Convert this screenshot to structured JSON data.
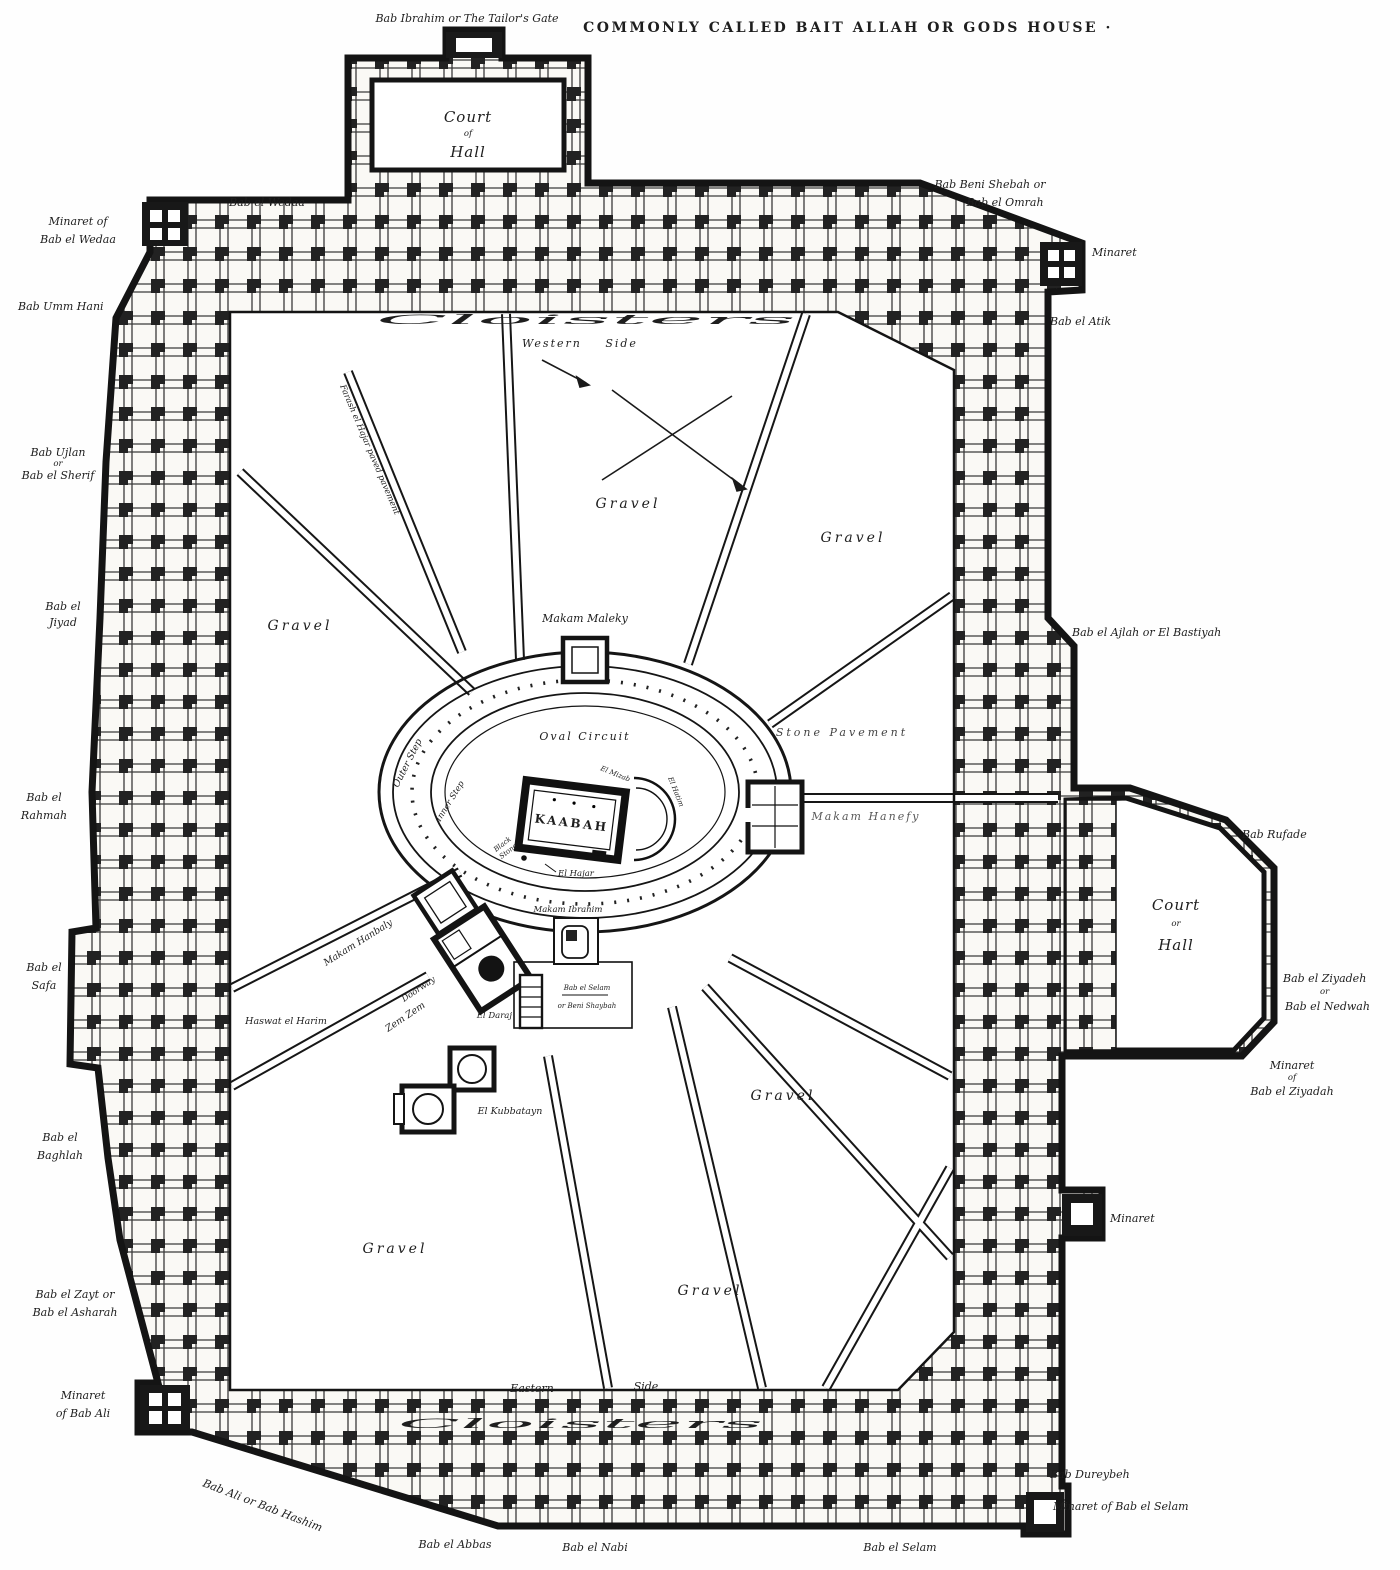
{
  "palette": {
    "ink": "#1c1c1c",
    "paper": "#ffffff"
  },
  "labels": {
    "title": "COMMONLY CALLED BAIT ALLAH OR GODS HOUSE ·",
    "bab_ibrahim": "Bab Ibrahim or The Tailor's Gate",
    "bab_el_wedaa": "Bab el Wedaa",
    "minaret_wedaa": [
      "Minaret of",
      "Bab el Wedaa"
    ],
    "bab_umm_hani": "Bab Umm Hani",
    "bab_ujlan": [
      "Bab Ujlan",
      "or",
      "Bab el Sherif"
    ],
    "bab_el_jiyad": [
      "Bab el",
      "Jiyad"
    ],
    "bab_el_rahmah": [
      "Bab el",
      "Rahmah"
    ],
    "bab_el_safa": [
      "Bab el",
      "Safa"
    ],
    "bab_el_baghlah": [
      "Bab el",
      "Baghlah"
    ],
    "bab_el_zayt": [
      "Bab el Zayt or",
      "Bab el Asharah"
    ],
    "minaret_bab_ali": [
      "Minaret",
      "of Bab Ali"
    ],
    "bab_ali_hashim": "Bab Ali or Bab Hashim",
    "bab_el_abbas": "Bab el Abbas",
    "bab_el_nabi": "Bab el Nabi",
    "bab_el_selam": "Bab el Selam",
    "bab_dureybeh": "Bab Dureybeh",
    "minaret_bab_selam": "Minaret of Bab el Selam",
    "bab_beni_shebah": [
      "Bab Beni Shebah or",
      "Bab el Omrah"
    ],
    "minaret_ne": "Minaret",
    "bab_el_atik": "Bab el Atik",
    "bab_el_ajlah": "Bab el Ajlah or El Bastiyah",
    "bab_rufade": "Bab Rufade",
    "bab_el_ziyadeh": [
      "Bab el Ziyadeh",
      "or",
      "Bab el Nedwah"
    ],
    "minaret_ziyadah": [
      "Minaret",
      "of",
      "Bab el Ziyadah"
    ],
    "minaret_e": "Minaret",
    "court_top": [
      "Court",
      "of",
      "Hall"
    ],
    "court_right": [
      "Court",
      "or",
      "Hall"
    ],
    "cloisters": "Cloisters",
    "western_side": "Western Side",
    "eastern": "Eastern",
    "side": "Side",
    "gravel": "Gravel",
    "farash": "Farash el Hajar  paved pavement",
    "makam_maleky": "Makam Maleky",
    "oval_circuit": "Oval Circuit",
    "outer_step": "Outer Step",
    "inner_step": "Inner Step",
    "stone_pavement": "Stone Pavement",
    "kaabah": "KAABAH",
    "makam_hanefy": "Makam Hanefy",
    "black_stone": [
      "Black",
      "Stone"
    ],
    "el_hajar": "El Hajar",
    "el_mizab": "El Mizab",
    "el_hatim": "El Hatim",
    "makam_hanbaly": "Makam Hanbaly",
    "doorway": "Doorway",
    "zem_zem": "Zem Zem",
    "el_daraj": "El Daraj",
    "makam_ibrahim": "Makam Ibrahim",
    "bab_selam_inner": [
      "Bab el Selam",
      "or Beni Shaybah"
    ],
    "el_kubbatayn": "El Kubbatayn",
    "haswat_harim": "Haswat el Harim"
  }
}
